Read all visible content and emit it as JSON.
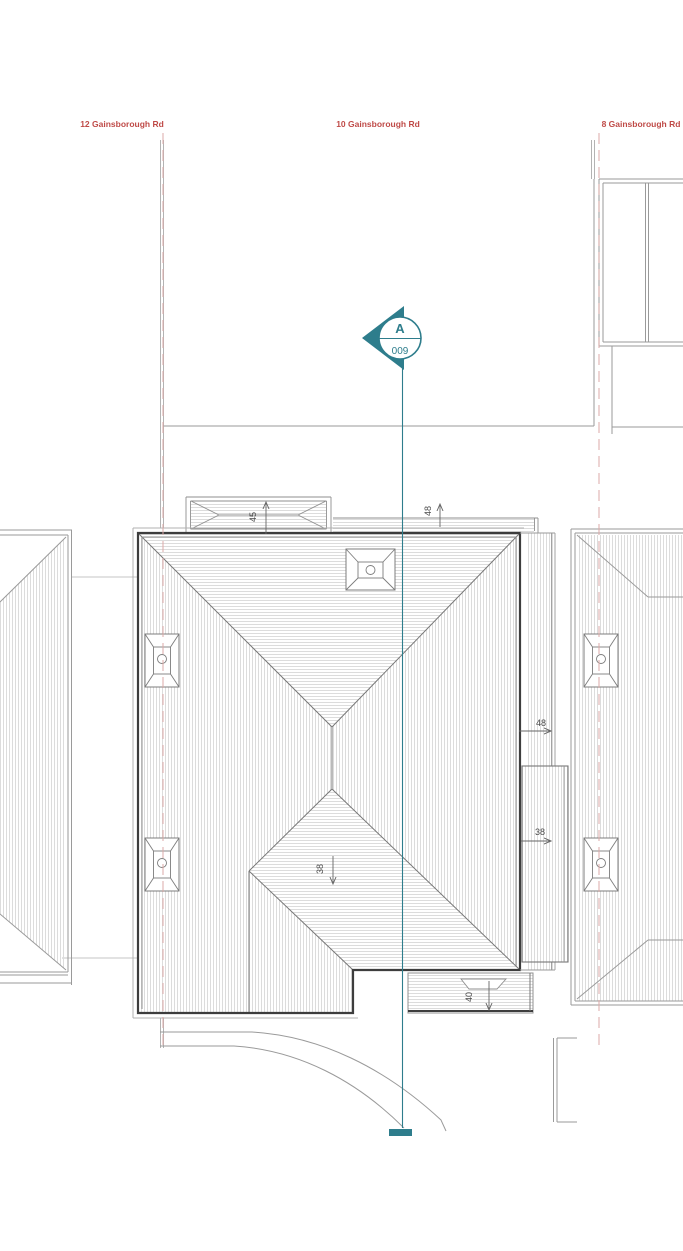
{
  "drawing": {
    "title_context": "roof plan",
    "properties": {
      "left": {
        "label": "12 Gainsborough Rd"
      },
      "center": {
        "label": "10 Gainsborough Rd"
      },
      "right": {
        "label": "8 Gainsborough Rd"
      }
    },
    "section_marker": {
      "letter": "A",
      "sheet_number": "009",
      "icon": "section-cut-marker"
    },
    "dimensions": {
      "canopy_top_left": "45",
      "strip_top_right": "48",
      "right_side_upper": "48",
      "right_side_lower": "38",
      "south_roof_slope": "38",
      "bottom_projection": "40"
    },
    "colors": {
      "accent_teal": "#2e7d8c",
      "label_red": "#bf4a47",
      "boundary_pink": "#dcaaa7",
      "outline_dark": "#3d3d3d",
      "line_gray": "#9a9a9a",
      "hatch_gray": "#dcdcdc"
    }
  }
}
